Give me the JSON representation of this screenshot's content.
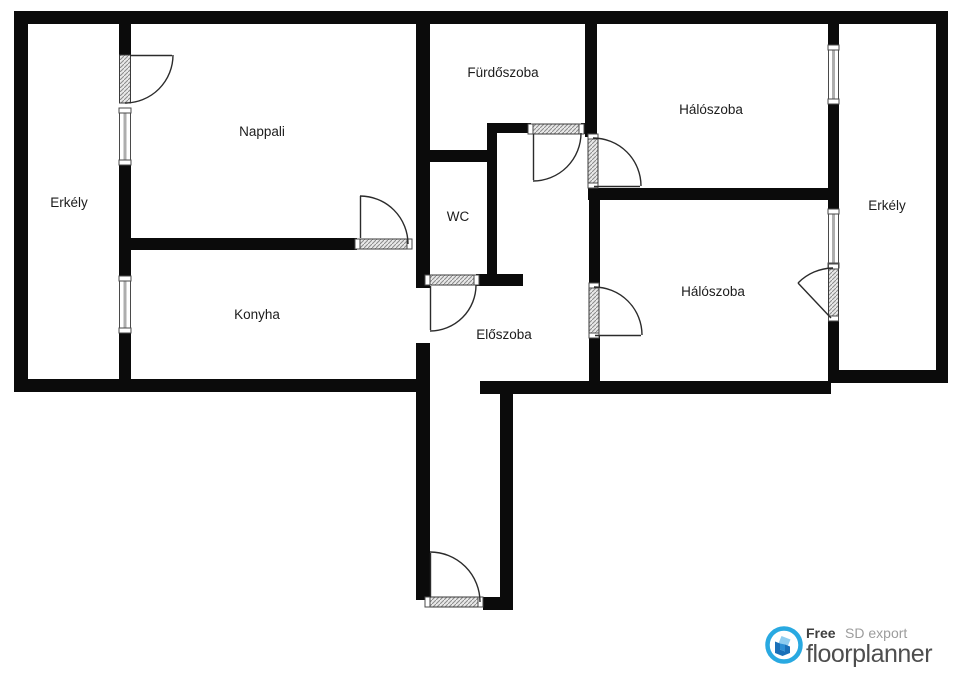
{
  "floorplan": {
    "rooms": [
      {
        "id": "erkely-left",
        "label": "Erkély"
      },
      {
        "id": "nappali",
        "label": "Nappali"
      },
      {
        "id": "furdoszoba",
        "label": "Fürdőszoba"
      },
      {
        "id": "haloszoba-top",
        "label": "Hálószoba"
      },
      {
        "id": "erkely-right",
        "label": "Erkély"
      },
      {
        "id": "wc",
        "label": "WC"
      },
      {
        "id": "konyha",
        "label": "Konyha"
      },
      {
        "id": "eloszoba",
        "label": "Előszoba"
      },
      {
        "id": "haloszoba-bottom",
        "label": "Hálószoba"
      }
    ]
  },
  "branding": {
    "free_label": "Free",
    "export_label": "SD export",
    "brand_name": "floorplanner",
    "brand_color": "#29A9E1",
    "wall_color": "#0b0b0b"
  }
}
